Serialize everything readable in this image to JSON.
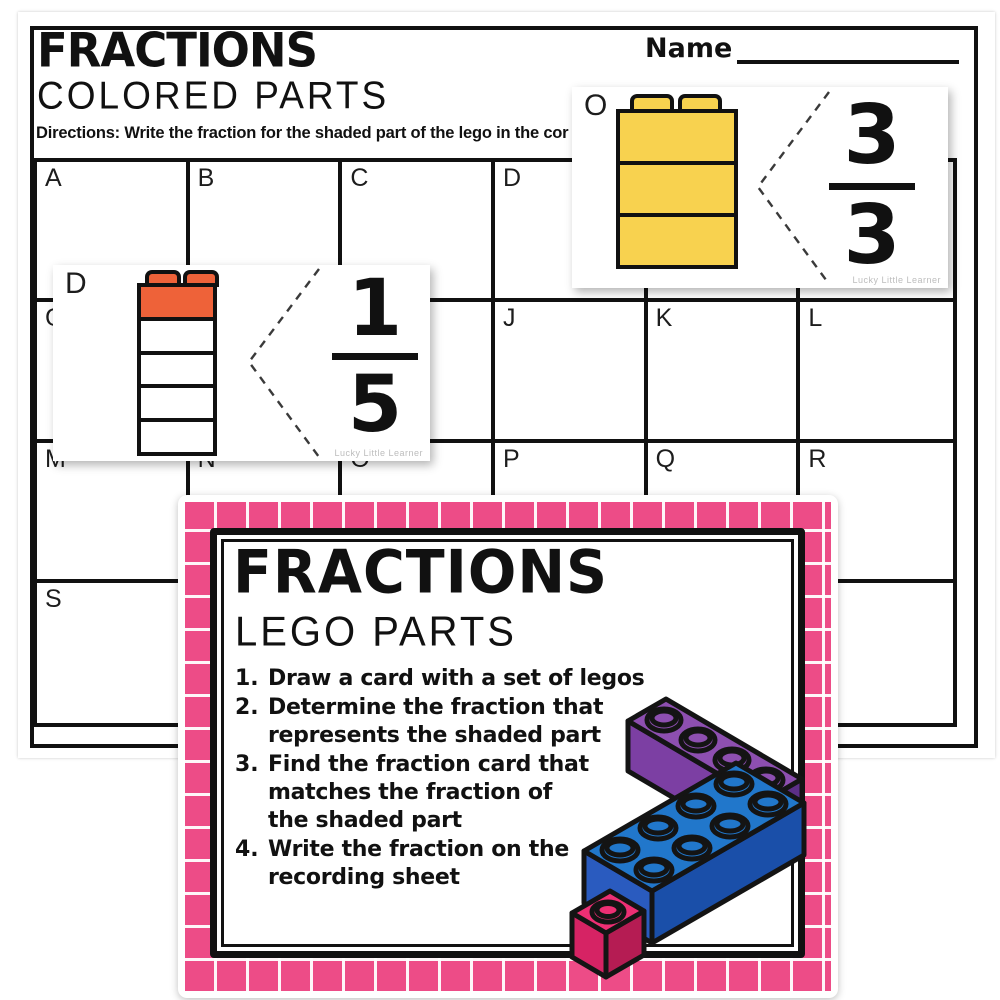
{
  "worksheet": {
    "title": "FRACTIONS",
    "subtitle": "COLORED PARTS",
    "directions": "Directions:  Write the fraction for the shaded part of the lego in the cor",
    "name_label": "Name",
    "grid_cells": [
      "A",
      "B",
      "C",
      "D",
      "",
      "",
      "G",
      "",
      "",
      "J",
      "K",
      "L",
      "M",
      "N",
      "O",
      "P",
      "Q",
      "R",
      "S",
      "",
      "",
      "",
      "",
      ""
    ]
  },
  "cards": {
    "card_o": {
      "label": "O",
      "numerator": "3",
      "denominator": "3",
      "shaded_parts": 3,
      "total_parts": 3,
      "brick_color": "#F8D24F",
      "watermark": "Lucky Little Learner"
    },
    "card_d": {
      "label": "D",
      "numerator": "1",
      "denominator": "5",
      "shaded_parts": 1,
      "total_parts": 5,
      "brick_color": "#EE6239",
      "watermark": "Lucky Little Learner"
    }
  },
  "instruction_card": {
    "title": "FRACTIONS",
    "subtitle": "LEGO PARTS",
    "border_color": "#ED4C87",
    "items": [
      {
        "number": "1.",
        "lines": [
          "Draw a card with a set of legos",
          "",
          ""
        ]
      },
      {
        "number": "2.",
        "lines": [
          "Determine the fraction that",
          "represents the shaded part",
          ""
        ]
      },
      {
        "number": "3.",
        "lines": [
          "Find the fraction card that",
          "matches the fraction of",
          "the shaded part"
        ]
      },
      {
        "number": "4.",
        "lines": [
          "Write the fraction on the",
          "recording sheet",
          ""
        ]
      }
    ],
    "brick_colors": {
      "purple": "#8D4FB0",
      "blue": "#2177CB",
      "pink": "#EE2F74"
    }
  }
}
